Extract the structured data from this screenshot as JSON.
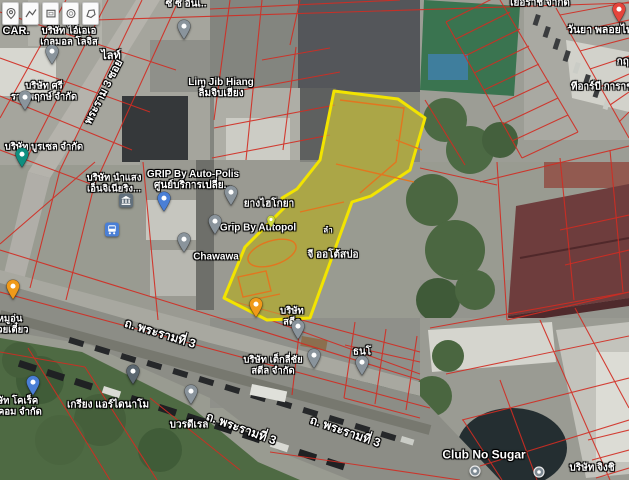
{
  "map": {
    "type_note": "satellite map with cadastral overlay and highlighted parcel",
    "colors": {
      "parcel_highlight": "#f2e400",
      "parcel_inner": "#e2761f",
      "cadastral_lines": "#d22c22",
      "pin_grey": "#8a949c",
      "pin_blue": "#4a7fd6",
      "pin_teal": "#0e8f80",
      "pin_orange": "#f09a1a",
      "pin_dark": "#5b6770",
      "pin_red": "#e5453c",
      "pin_mini_green": "#cdd93e",
      "bus_icon_bg": "#4a7fd6",
      "bank_icon_bg": "#62707c"
    },
    "toolbar": {
      "tools": [
        {
          "name": "marker-tool"
        },
        {
          "name": "polyline-tool"
        },
        {
          "name": "rectangle-tool"
        },
        {
          "name": "circle-tool"
        },
        {
          "name": "polygon-tool"
        }
      ]
    },
    "labels": [
      {
        "name": "label-car",
        "text": "CAR.",
        "x": 16,
        "y": 31,
        "size": 11
      },
      {
        "name": "label-company-iae",
        "lines": [
          "บริษัท ไอ์เอเอ",
          "เกลมอล โลจิส"
        ],
        "x": 69,
        "y": 37,
        "size": 9.5
      },
      {
        "name": "label-cc-inter",
        "text": "ซี ซี อินเ..",
        "x": 186,
        "y": 4,
        "size": 10
      },
      {
        "name": "label-light",
        "text": "ไลท์",
        "x": 111,
        "y": 56,
        "size": 11
      },
      {
        "name": "label-soi-rama3",
        "text": "พระราม 3 ซอย",
        "x": 104,
        "y": 92,
        "size": 11,
        "rotate": -63
      },
      {
        "name": "label-company-sri",
        "lines": [
          "บริษัท ศรี",
          "ราชพฤกษ์ จำกัด"
        ],
        "x": 44,
        "y": 92,
        "size": 9.5
      },
      {
        "name": "label-company-burasel",
        "text": "บริษัท บูรเซล จำกัด",
        "x": 44,
        "y": 148,
        "size": 9.5
      },
      {
        "name": "label-lim-jib-hiang",
        "lines": [
          "Lim Jib Hiang",
          "ลิ้มจิบเฮียง"
        ],
        "x": 221,
        "y": 88,
        "size": 10
      },
      {
        "name": "label-yeorach",
        "text": "เยอราช จำกัด",
        "x": 540,
        "y": 3,
        "size": 10
      },
      {
        "name": "label-wanya",
        "text": "วันยา พลอยไพ",
        "x": 600,
        "y": 31,
        "size": 10.5
      },
      {
        "name": "label-krit",
        "text": "กฤษ",
        "x": 626,
        "y": 62,
        "size": 10
      },
      {
        "name": "label-trb-garage",
        "text": "ทีอาร์บี การาช",
        "x": 602,
        "y": 87,
        "size": 10
      },
      {
        "name": "label-company-namsaeng",
        "lines": [
          "บริษัท นำแสง",
          "เอ็นจิเนียริง..."
        ],
        "x": 114,
        "y": 184,
        "size": 9.5
      },
      {
        "name": "label-grip-auto-polis",
        "lines": [
          "GRIP By Auto-Polis",
          "ศูนย์บริการเปลี่ย..."
        ],
        "x": 193,
        "y": 180,
        "size": 10
      },
      {
        "name": "label-yang-hiko",
        "text": "ยางไฮโกยา",
        "x": 269,
        "y": 204,
        "size": 10
      },
      {
        "name": "label-grip-by-autopol",
        "text": "Grip By Autopol",
        "x": 258,
        "y": 228,
        "size": 10
      },
      {
        "name": "label-chawawa",
        "text": "Chawawa",
        "x": 216,
        "y": 257,
        "size": 10
      },
      {
        "name": "label-g-auto-spo",
        "text": "จี ออโต้สปอ",
        "x": 333,
        "y": 255,
        "size": 10
      },
      {
        "name": "label-lam",
        "text": "ลำ",
        "x": 328,
        "y": 231,
        "size": 8
      },
      {
        "name": "label-company-steel",
        "lines": [
          "บริษัท",
          "สตีล"
        ],
        "x": 292,
        "y": 317,
        "size": 9.5
      },
      {
        "name": "label-company-teklichai",
        "lines": [
          "บริษัท เต็กลี่ชัย",
          "สตีล จำกัด"
        ],
        "x": 273,
        "y": 366,
        "size": 9.5
      },
      {
        "name": "label-thano",
        "text": "ธนโ",
        "x": 362,
        "y": 352,
        "size": 10
      },
      {
        "name": "label-road-rama3-a",
        "text": "ถ. พระรามที่ 3",
        "x": 160,
        "y": 334,
        "size": 12,
        "rotate": 17
      },
      {
        "name": "label-road-rama3-b",
        "text": "ถ. พระรามที่ 3",
        "x": 241,
        "y": 429,
        "size": 12,
        "rotate": 20
      },
      {
        "name": "label-road-rama3-c",
        "text": "ถ. พระรามที่ 3",
        "x": 345,
        "y": 432,
        "size": 12,
        "rotate": 19
      },
      {
        "name": "label-muun-noodle",
        "lines": [
          "หมูอุ่น",
          "ก๋วยเตี๋ยว"
        ],
        "x": 10,
        "y": 325,
        "size": 9.5
      },
      {
        "name": "label-company-correct",
        "lines": [
          "บริษัท โคเร็ค",
          "เทคคอม จำกัด"
        ],
        "x": 12,
        "y": 407,
        "size": 9.5
      },
      {
        "name": "label-kriang-dynamo",
        "text": "เกรียง แอร์ไดนาโม",
        "x": 108,
        "y": 405,
        "size": 10
      },
      {
        "name": "label-bowondee",
        "text": "บวรดีเรล",
        "x": 189,
        "y": 425,
        "size": 10
      },
      {
        "name": "label-club-no-sugar",
        "text": "Club No Sugar",
        "x": 484,
        "y": 455,
        "size": 12
      },
      {
        "name": "label-company-jingchi",
        "text": "บริษัท จิงชิ",
        "x": 592,
        "y": 468,
        "size": 10
      }
    ],
    "pins": [
      {
        "name": "pin-cc-inter",
        "kind": "pin",
        "color": "#8a949c",
        "x": 184,
        "y": 45
      },
      {
        "name": "pin-company-iae",
        "kind": "pin",
        "color": "#8a949c",
        "x": 52,
        "y": 70
      },
      {
        "name": "pin-company-sri",
        "kind": "pin",
        "color": "#8a949c",
        "x": 25,
        "y": 116
      },
      {
        "name": "pin-teal-poi",
        "kind": "pin",
        "color": "#0e8f80",
        "x": 22,
        "y": 173
      },
      {
        "name": "pin-blue-poi",
        "kind": "pin",
        "color": "#4a7fd6",
        "x": 164,
        "y": 217
      },
      {
        "name": "pin-yang-hiko",
        "kind": "pin",
        "color": "#8a949c",
        "x": 231,
        "y": 211
      },
      {
        "name": "pin-grip-autopol",
        "kind": "pin",
        "color": "#8a949c",
        "x": 215,
        "y": 240
      },
      {
        "name": "pin-chawawa",
        "kind": "pin",
        "color": "#8a949c",
        "x": 184,
        "y": 258
      },
      {
        "name": "pin-mini-green",
        "kind": "mini",
        "color": "#cdd93e",
        "x": 271,
        "y": 233
      },
      {
        "name": "pin-muun-noodle",
        "kind": "pin",
        "color": "#f09a1a",
        "x": 13,
        "y": 305
      },
      {
        "name": "pin-parcel-orange",
        "kind": "pin",
        "color": "#f09a1a",
        "x": 256,
        "y": 323
      },
      {
        "name": "pin-company-correct",
        "kind": "pin",
        "color": "#4a7fd6",
        "x": 33,
        "y": 401
      },
      {
        "name": "pin-kriang-dynamo",
        "kind": "pin",
        "color": "#5b6770",
        "x": 133,
        "y": 390
      },
      {
        "name": "pin-bowondee",
        "kind": "pin",
        "color": "#8a949c",
        "x": 191,
        "y": 410
      },
      {
        "name": "pin-company-steel",
        "kind": "pin",
        "color": "#8a949c",
        "x": 298,
        "y": 345
      },
      {
        "name": "pin-company-teklichai",
        "kind": "pin",
        "color": "#8a949c",
        "x": 314,
        "y": 374
      },
      {
        "name": "pin-thano",
        "kind": "pin",
        "color": "#8a949c",
        "x": 362,
        "y": 381
      },
      {
        "name": "pin-wanya-red",
        "kind": "pin",
        "color": "#e5453c",
        "x": 619,
        "y": 28
      },
      {
        "name": "pin-club-no-sugar-dot",
        "kind": "dot",
        "color": "#7e8a93",
        "x": 475,
        "y": 473
      },
      {
        "name": "pin-jingchi-dot",
        "kind": "dot",
        "color": "#7e8a93",
        "x": 539,
        "y": 474
      }
    ],
    "poi_icons": [
      {
        "name": "bank-icon",
        "kind": "bank",
        "x": 126,
        "y": 203
      },
      {
        "name": "bus-stop-icon",
        "kind": "bus",
        "x": 112,
        "y": 232
      }
    ]
  }
}
